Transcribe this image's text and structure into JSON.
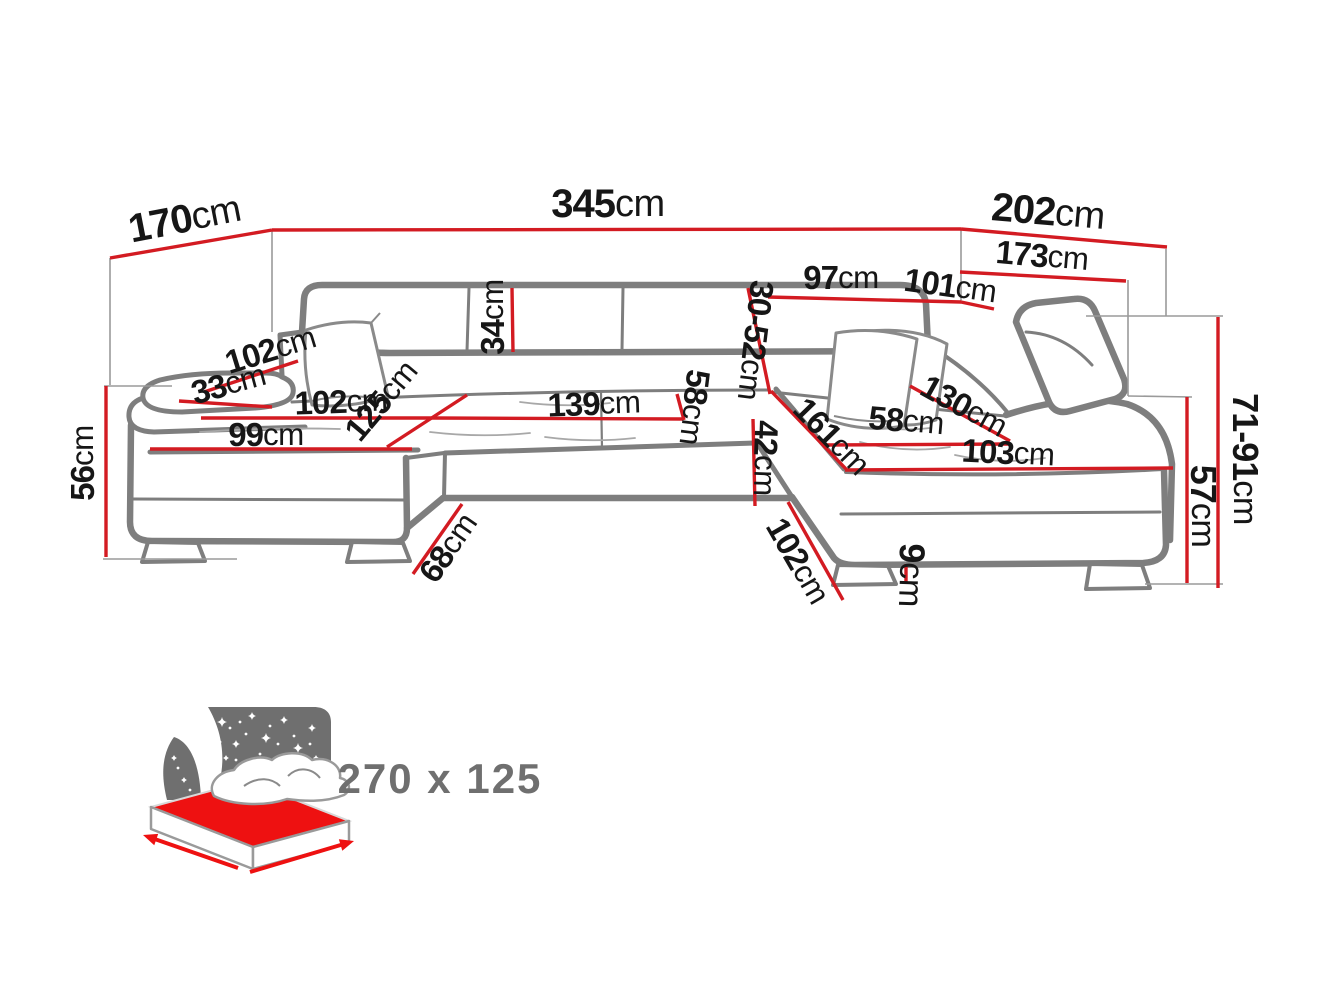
{
  "canvas": {
    "width": 1320,
    "height": 990,
    "background": "#ffffff"
  },
  "colors": {
    "dimension_line": "#d31b22",
    "sofa_outline": "#7e7e7e",
    "construction_line": "#9a9a9a",
    "label_text": "#161616",
    "icon_gray": "#6f6f6f",
    "icon_red": "#ee1111"
  },
  "dimensions": [
    {
      "name": "overall-depth-left",
      "value": "170",
      "unit": "cm",
      "label": {
        "x": 185,
        "y": 221,
        "rotate": -11,
        "size": 40
      },
      "lines": [
        [
          110,
          258,
          272,
          230
        ]
      ]
    },
    {
      "name": "overall-width",
      "value": "345",
      "unit": "cm",
      "label": {
        "x": 608,
        "y": 206,
        "rotate": 0,
        "size": 40
      },
      "lines": [
        [
          272,
          230,
          961,
          229
        ]
      ]
    },
    {
      "name": "overall-depth-right",
      "value": "202",
      "unit": "cm",
      "label": {
        "x": 1048,
        "y": 214,
        "rotate": 5,
        "size": 40
      },
      "lines": [
        [
          961,
          229,
          1167,
          247
        ]
      ]
    },
    {
      "name": "back-depth-right",
      "value": "173",
      "unit": "cm",
      "label": {
        "x": 1042,
        "y": 258,
        "rotate": 5,
        "size": 33
      },
      "lines": [
        [
          960,
          272,
          1126,
          281
        ]
      ]
    },
    {
      "name": "backrest-top-width",
      "value": "97",
      "unit": "cm",
      "label": {
        "x": 841,
        "y": 280,
        "rotate": 0,
        "size": 33
      },
      "lines": [
        [
          768,
          297,
          961,
          302
        ]
      ]
    },
    {
      "name": "backrest-top-width-2",
      "value": "101",
      "unit": "cm",
      "label": {
        "x": 950,
        "y": 288,
        "rotate": 8,
        "size": 33
      },
      "lines": [
        [
          961,
          302,
          994,
          309
        ]
      ]
    },
    {
      "name": "backrest-height",
      "value": "34",
      "unit": "cm",
      "label": {
        "x": 495,
        "y": 317,
        "rotate": -90,
        "size": 33
      },
      "lines": [
        [
          512,
          288,
          513,
          352
        ]
      ]
    },
    {
      "name": "headrest-range",
      "value": "30-52",
      "unit": "cm",
      "label": {
        "x": 753,
        "y": 340,
        "rotate": 97,
        "size": 33
      },
      "lines": [
        [
          748,
          288,
          770,
          394
        ]
      ]
    },
    {
      "name": "armrest-top-length",
      "value": "102",
      "unit": "cm",
      "label": {
        "x": 271,
        "y": 352,
        "rotate": -17,
        "size": 33
      },
      "lines": [
        [
          204,
          392,
          298,
          361
        ]
      ]
    },
    {
      "name": "armrest-top-width",
      "value": "33",
      "unit": "cm",
      "label": {
        "x": 229,
        "y": 386,
        "rotate": -15,
        "size": 33
      },
      "lines": [
        [
          179,
          401,
          272,
          407
        ]
      ]
    },
    {
      "name": "seat-width-left",
      "value": "102",
      "unit": "cm",
      "label": {
        "x": 341,
        "y": 404,
        "rotate": -2,
        "size": 33
      },
      "lines": [
        [
          201,
          418,
          432,
          418
        ]
      ]
    },
    {
      "name": "chaise-length-left",
      "value": "125",
      "unit": "cm",
      "label": {
        "x": 383,
        "y": 402,
        "rotate": -50,
        "size": 33
      },
      "lines": [
        [
          387,
          447,
          467,
          395
        ]
      ]
    },
    {
      "name": "seat-width-middle",
      "value": "139",
      "unit": "cm",
      "label": {
        "x": 594,
        "y": 406,
        "rotate": -2,
        "size": 33
      },
      "lines": [
        [
          432,
          418,
          683,
          419
        ]
      ]
    },
    {
      "name": "seat-depth-middle",
      "value": "58",
      "unit": "cm",
      "label": {
        "x": 692,
        "y": 407,
        "rotate": 97,
        "size": 33
      },
      "lines": [
        [
          677,
          394,
          684,
          420
        ]
      ]
    },
    {
      "name": "chaise-front-left",
      "value": "99",
      "unit": "cm",
      "label": {
        "x": 266,
        "y": 437,
        "rotate": 0,
        "size": 33
      },
      "lines": [
        [
          150,
          449,
          412,
          449
        ]
      ]
    },
    {
      "name": "seat-height-left",
      "value": "56",
      "unit": "cm",
      "label": {
        "x": 85,
        "y": 463,
        "rotate": -90,
        "size": 33
      },
      "lines": [
        [
          106,
          386,
          106,
          557
        ]
      ]
    },
    {
      "name": "front-height-middle",
      "value": "42",
      "unit": "cm",
      "label": {
        "x": 763,
        "y": 458,
        "rotate": 92,
        "size": 33
      },
      "lines": [
        [
          753,
          419,
          755,
          506
        ]
      ]
    },
    {
      "name": "chaise-length-right",
      "value": "161",
      "unit": "cm",
      "label": {
        "x": 830,
        "y": 438,
        "rotate": 46,
        "size": 33
      },
      "lines": [
        [
          771,
          391,
          847,
          470
        ]
      ]
    },
    {
      "name": "seat-depth-right",
      "value": "58",
      "unit": "cm",
      "label": {
        "x": 906,
        "y": 423,
        "rotate": 5,
        "size": 33
      },
      "lines": [
        [
          823,
          445,
          1010,
          444
        ]
      ]
    },
    {
      "name": "backrest-right-length",
      "value": "130",
      "unit": "cm",
      "label": {
        "x": 963,
        "y": 408,
        "rotate": 29,
        "size": 33
      },
      "lines": [
        [
          910,
          386,
          1010,
          441
        ]
      ]
    },
    {
      "name": "chaise-front-right",
      "value": "103",
      "unit": "cm",
      "label": {
        "x": 1008,
        "y": 455,
        "rotate": 3,
        "size": 33
      },
      "lines": [
        [
          845,
          470,
          1173,
          468
        ]
      ]
    },
    {
      "name": "passage-width",
      "value": "68",
      "unit": "cm",
      "label": {
        "x": 450,
        "y": 549,
        "rotate": -55,
        "size": 33
      },
      "lines": [
        [
          462,
          504,
          413,
          574
        ]
      ]
    },
    {
      "name": "chaise-side-right",
      "value": "102",
      "unit": "cm",
      "label": {
        "x": 796,
        "y": 562,
        "rotate": 60,
        "size": 33
      },
      "lines": [
        [
          788,
          502,
          843,
          600
        ]
      ]
    },
    {
      "name": "foot-height",
      "value": "9",
      "unit": "cm",
      "label": {
        "x": 909,
        "y": 575,
        "rotate": 92,
        "size": 36
      },
      "lines": [
        [
          906,
          564,
          906,
          584
        ]
      ]
    },
    {
      "name": "height-range",
      "value": "71-91",
      "unit": "cm",
      "label": {
        "x": 1243,
        "y": 459,
        "rotate": 90,
        "size": 36
      },
      "lines": [
        [
          1218,
          317,
          1218,
          588
        ]
      ]
    },
    {
      "name": "seat-height-right",
      "value": "57",
      "unit": "cm",
      "label": {
        "x": 1201,
        "y": 506,
        "rotate": 90,
        "size": 36
      },
      "lines": [
        [
          1187,
          397,
          1187,
          583
        ]
      ]
    }
  ],
  "construction_lines": [
    [
      110,
      258,
      110,
      385
    ],
    [
      104,
      386,
      172,
      386
    ],
    [
      103,
      559,
      237,
      559
    ],
    [
      272,
      230,
      272,
      332
    ],
    [
      961,
      230,
      961,
      303
    ],
    [
      1166,
      249,
      1166,
      316
    ],
    [
      1086,
      316,
      1223,
      316
    ],
    [
      1128,
      280,
      1128,
      396
    ],
    [
      1128,
      396,
      1192,
      397
    ],
    [
      1145,
      584,
      1223,
      584
    ]
  ],
  "sleeping_icon": {
    "label": "270 x 125",
    "stars_diamond": [
      [
        222,
        722,
        5
      ],
      [
        236,
        744,
        4
      ],
      [
        252,
        716,
        4
      ],
      [
        266,
        738,
        5
      ],
      [
        284,
        720,
        4
      ],
      [
        298,
        748,
        5
      ],
      [
        312,
        728,
        4
      ],
      [
        242,
        772,
        4
      ],
      [
        272,
        766,
        4
      ],
      [
        302,
        774,
        4
      ],
      [
        226,
        758,
        3
      ],
      [
        290,
        790,
        4
      ],
      [
        256,
        788,
        3
      ],
      [
        316,
        758,
        3
      ],
      [
        206,
        748,
        3
      ],
      [
        318,
        788,
        3
      ],
      [
        174,
        758,
        3
      ],
      [
        184,
        780,
        3
      ]
    ],
    "stars_dot": [
      [
        230,
        728
      ],
      [
        246,
        734
      ],
      [
        260,
        754
      ],
      [
        278,
        744
      ],
      [
        294,
        736
      ],
      [
        306,
        762
      ],
      [
        236,
        760
      ],
      [
        218,
        770
      ],
      [
        310,
        744
      ],
      [
        264,
        780
      ],
      [
        284,
        764
      ],
      [
        228,
        784
      ],
      [
        178,
        768
      ],
      [
        190,
        790
      ],
      [
        220,
        742
      ],
      [
        240,
        722
      ],
      [
        270,
        726
      ],
      [
        298,
        786
      ],
      [
        320,
        768
      ],
      [
        250,
        762
      ]
    ],
    "arrows": [
      {
        "from": [
          238,
          868
        ],
        "to": [
          143,
          835
        ]
      },
      {
        "from": [
          250,
          872
        ],
        "to": [
          354,
          841
        ]
      }
    ]
  }
}
